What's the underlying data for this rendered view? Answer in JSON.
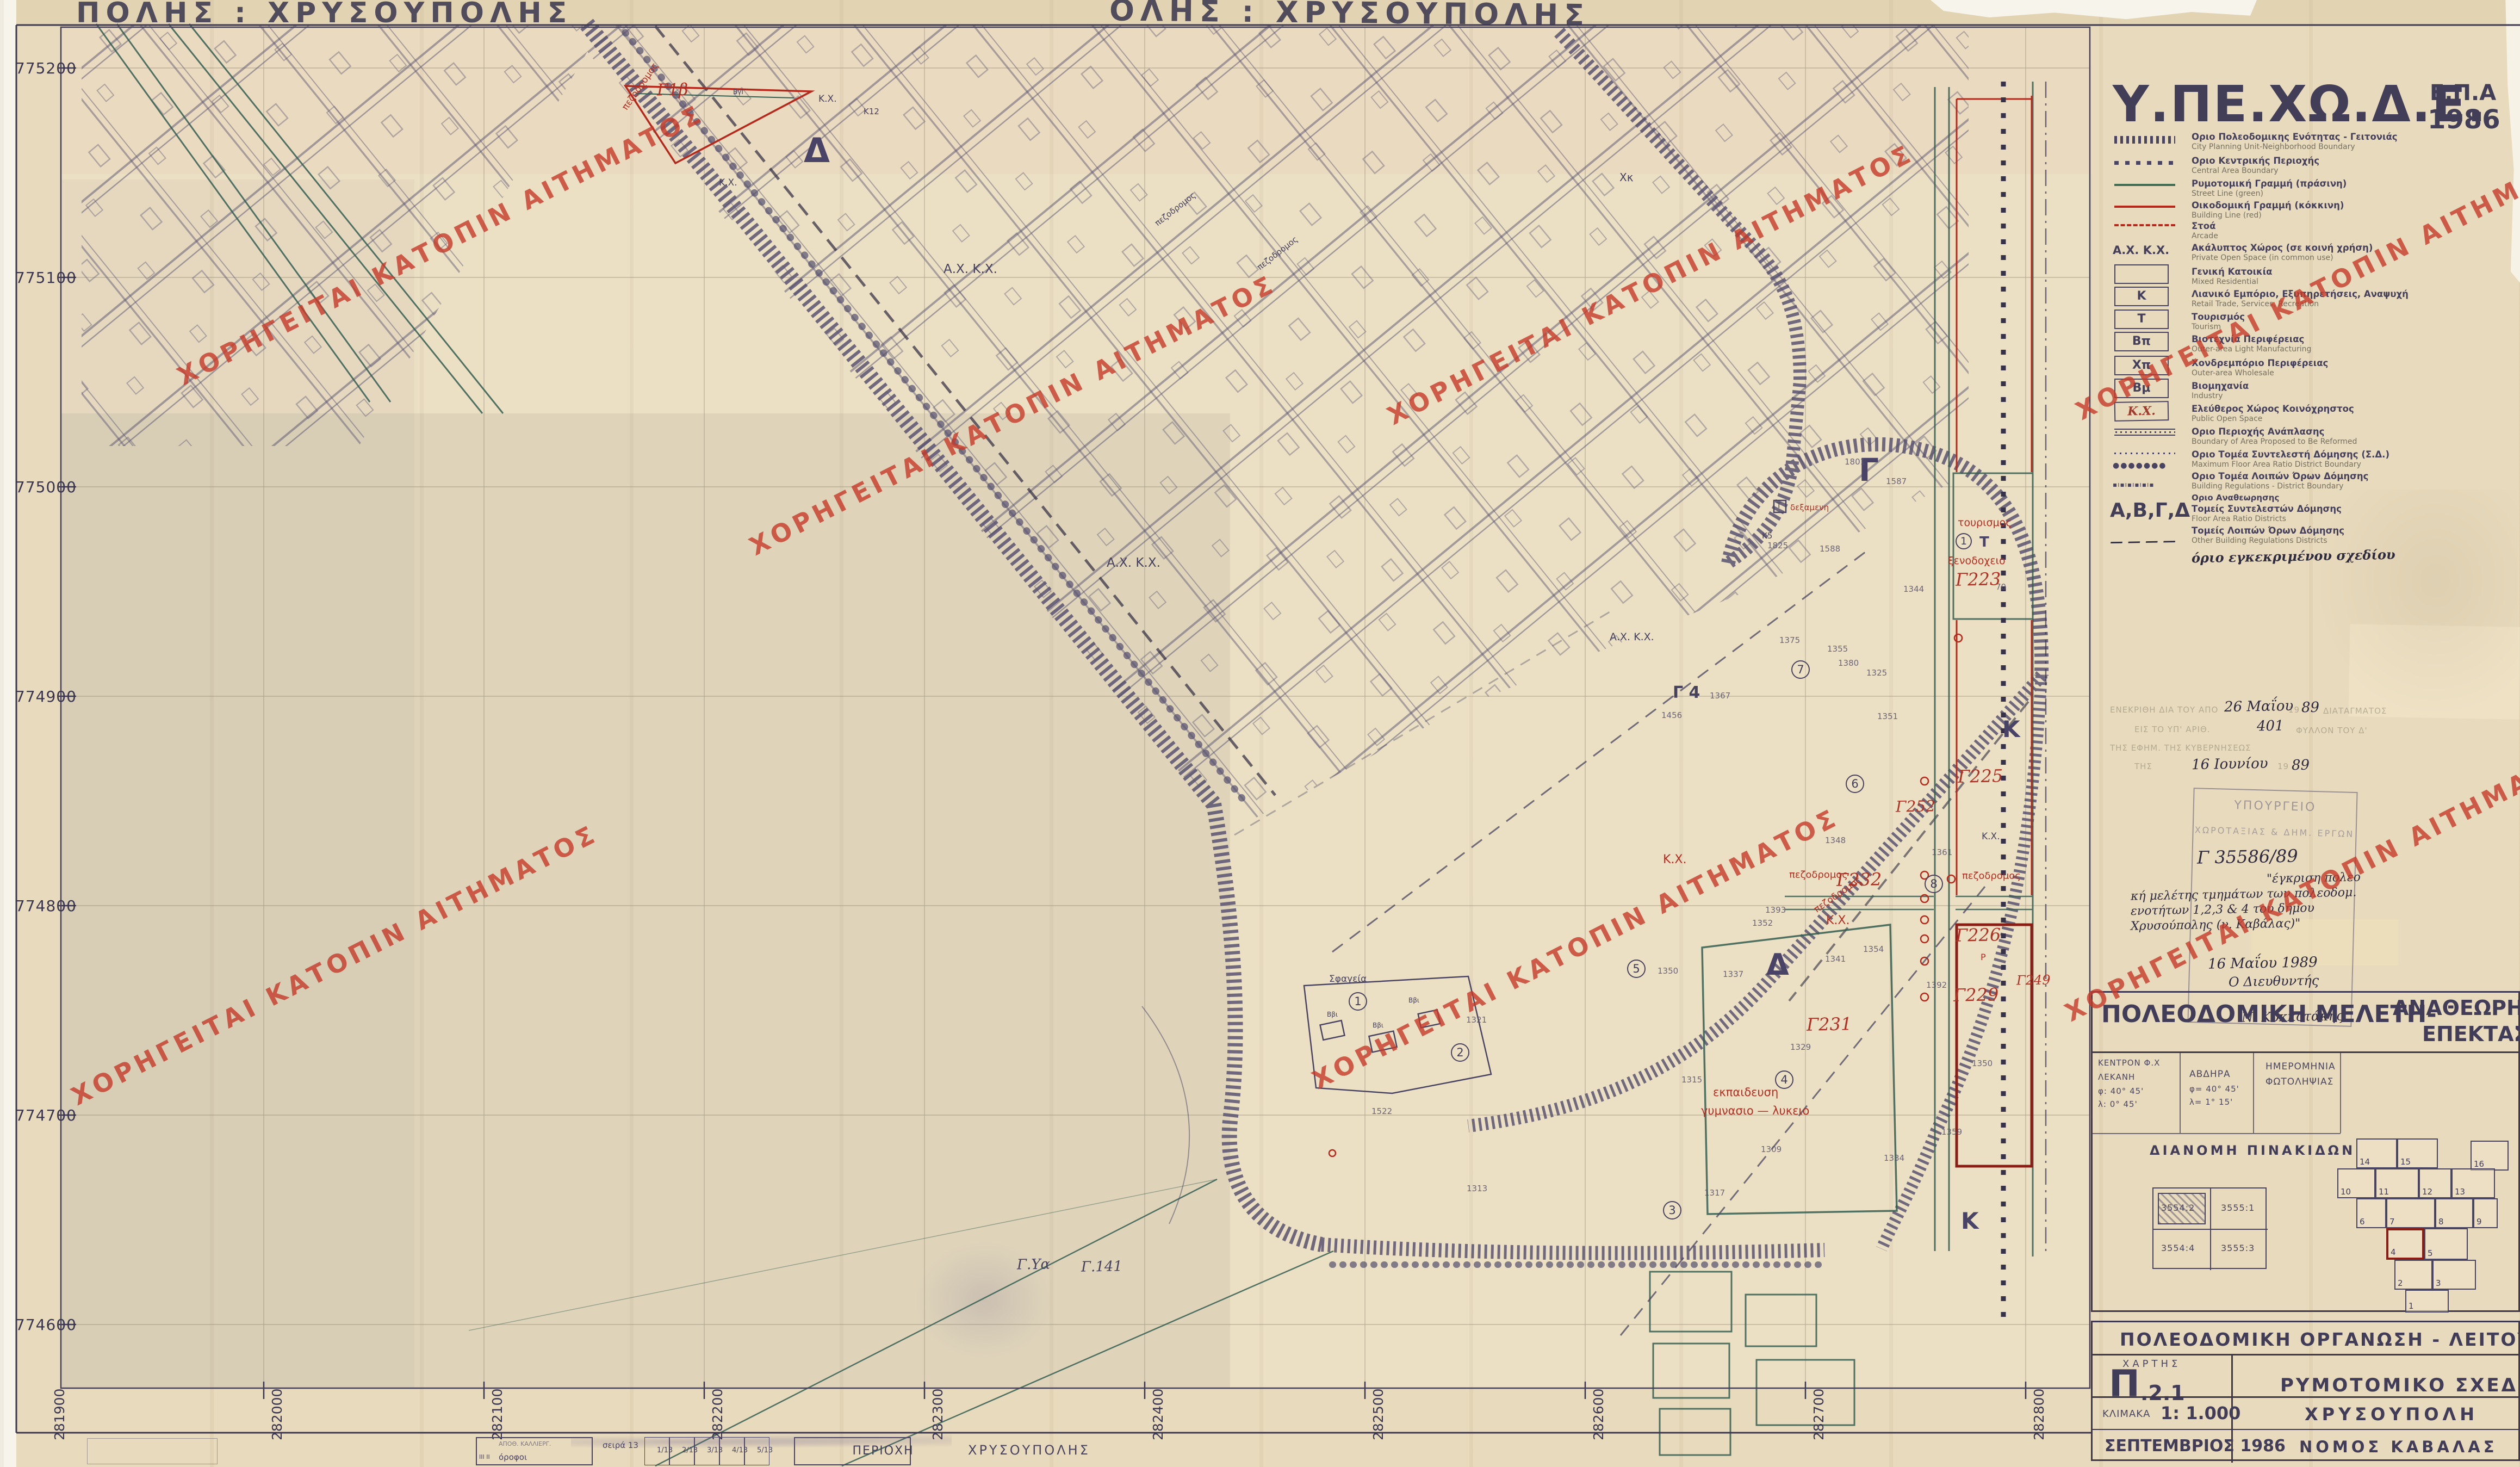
{
  "page": {
    "watermark_text": "ΧΟΡΗΓΕΙΤΑΙ ΚΑΤΟΠΙΝ ΑΙΤΗΜΑΤΟΣ",
    "watermark_color": "#c43b2a"
  },
  "margins": {
    "stencil_left": "ΠΟΛΗΣ :  ΧΡΥΣΟΥΠΟΛΗΣ",
    "stencil_center": "ΟΛΗΣ :  ΧΡΥΣΟΥΠΟΛΗΣ",
    "strip": {
      "apoth": "ΑΠΟΘ. ΚΑΛΛΙΕΡΓ.",
      "orofoi": "όροφοι",
      "marks": "ΙΙΙ ΙΙ",
      "seira": "σειρά 13",
      "cells": [
        "1/13",
        "2/13",
        "3/13",
        "4/13",
        "5/13"
      ],
      "periochi": "ΠΕΡΙΟΧΗ",
      "poli": "ΧΡΥΣΟΥΠΟΛΗΣ"
    }
  },
  "header": {
    "ministry": "Υ.ΠΕ.ΧΩ.Δ.Ε.",
    "epa": "Ε.Π.Α",
    "year": "1986"
  },
  "legend": {
    "items": [
      {
        "gr": "Οριο Πολεοδομικης Ενότητας - Γειτονιάς",
        "en": "City Planning Unit-Neighborhood Boundary"
      },
      {
        "gr": "Οριο Κεντρικής Περιοχής",
        "en": "Central Area Boundary"
      },
      {
        "gr": "Ρυμοτομική Γραμμή (πράσινη)",
        "en": "Street Line (green)"
      },
      {
        "gr": "Οικοδομική Γραμμή (κόκκινη)",
        "en": "Building Line (red)"
      },
      {
        "gr": "Στοά",
        "en": "Arcade"
      },
      {
        "gr": "Ακάλυπτος Χώρος (σε κοινή χρήση)",
        "en": "Private Open Space (in common use)",
        "sym_label": "Α.Χ. Κ.Χ."
      },
      {
        "gr": "Γενική Κατοικία",
        "en": "Mixed Residential",
        "box": ""
      },
      {
        "gr": "Λιανικό Εμπόριο, Εξυπηρετήσεις, Αναψυχή",
        "en": "Retail Trade, Services, Recreation",
        "box": "Κ"
      },
      {
        "gr": "Τουρισμός",
        "en": "Tourism",
        "box": "Τ"
      },
      {
        "gr": "Βιοτεχνία Περιφέρειας",
        "en": "Outer-area Light Manufacturing",
        "box": "Βπ"
      },
      {
        "gr": "Χονδρεμπόριο Περιφέρειας",
        "en": "Outer-area Wholesale",
        "box": "Χπ"
      },
      {
        "gr": "Βιομηχανία",
        "en": "Industry",
        "box": "Βμ"
      },
      {
        "gr": "Ελεύθερος Χώρος Κοινόχρηστος",
        "en": "Public Open Space",
        "box": "Κ.Χ."
      },
      {
        "gr": "Οριο Περιοχής Ανάπλασης",
        "en": "Boundary of Area Proposed to Be Reformed"
      },
      {
        "gr": "Οριο Τομέα Συντελεστή Δόμησης (Σ.Δ.)",
        "en": "Maximum Floor Area Ratio District Boundary"
      },
      {
        "gr": "Οριο Τομέα Λοιπών Όρων Δόμησης",
        "en": "Building Regulations - District Boundary",
        "sym_label": "●●●●●●●"
      },
      {
        "gr": "Οριο Αναθεωρησης",
        "en": "",
        "sym_label": "▪ı▪ı▪ı▪ı▪ı▪"
      },
      {
        "gr": "Τομείς Συντελεστών Δόμησης",
        "en": "Floor Area Ratio Districts",
        "gr2": "Τομείς Λοιπών Όρων Δόμησης",
        "en2": "Other Building Regulations Districts",
        "sym_label": "Α,Β,Γ,Δ"
      },
      {
        "gr": "όριο εγκεκριμένου σχεδίου",
        "en": "",
        "sym_label": "— — — —"
      }
    ]
  },
  "axes": {
    "left": [
      "775200",
      "775100",
      "775000",
      "774900",
      "774800",
      "774700",
      "774600"
    ],
    "bottom": [
      "281900",
      "282000",
      "282100",
      "282200",
      "282300",
      "282400",
      "282500",
      "282600",
      "282700",
      "282800"
    ]
  },
  "stamp": {
    "typed1a": "ΕΝΕΚΡΙΘΗ ΔΙΑ ΤΟΥ ΑΠΟ",
    "hw_date1": "26 Μαΐου",
    "typed_19a": "19",
    "hw_89a": "89",
    "typed1b": "ΔΙΑΤΑΓΜΑΤΟΣ",
    "typed2a": "ΕΙΣ ΤΟ ΥΠ' ΑΡΙΘ.",
    "hw_401": "401",
    "typed2b": "ΦΥΛΛΟΝ ΤΟΥ Δ'",
    "typed3": "ΤΗΣ ΕΦΗΜ. ΤΗΣ ΚΥΒΕΡΝΗΣΕΩΣ",
    "typed4": "ΤΗΣ",
    "hw_date2": "16 Ιουνίου",
    "typed_19b": "19",
    "hw_89b": "89",
    "box_line1": "ΥΠΟΥΡΓΕΙΟ",
    "box_line2": "ΧΩΡΟΤΑΞΙΑΣ & ΔΗΜ. ΕΡΓΩΝ",
    "protocol": "Γ 35586/89",
    "note1": "\"έγκριση πολεο",
    "note2": "κή μελέτης τμημάτων των πολεοδομ.",
    "note3": "ενοτήτων 1,2,3 & 4 του δήμου",
    "note4": "Χρυσούπολης (ν. Καβάλας)\"",
    "hw_date3": "16 Μαΐου 1989",
    "director": "Ο Διευθυντής",
    "signature": "Ν. Κοκκοτάκης"
  },
  "panel": {
    "title1": "ΠΟΛΕΟΔΟΜΙΚΗ ΜΕΛΕΤΗ-",
    "title2": "ΑΝΑΘΕΩΡΗΣΗ",
    "title3": "ΕΠΕΚΤΑΣΗ",
    "kentron": "ΚΕΝΤΡΟΝ Φ.Χ",
    "lekani": "ΛΕΚΑΝΗ",
    "f1": "φ: 40° 45'",
    "l1": "λ: 0° 45'",
    "avdira": "ΑΒΔΗΡΑ",
    "f2": "φ= 40° 45'",
    "l2": "λ= 1° 15'",
    "imerominia": "ΗΜΕΡΟΜΗΝΙΑ",
    "fotolipsias": "ΦΩΤΟΛΗΨΙΑΣ",
    "dianomi": "ΔΙΑΝΟΜΗ  ΠΙΝΑΚΙΔΩΝ",
    "sheets": [
      "3554:2",
      "3555:1",
      "3554:4",
      "3555:3"
    ],
    "tiles": [
      "14",
      "15",
      "16",
      "10",
      "11",
      "12",
      "13",
      "6",
      "7",
      "8",
      "9",
      "4",
      "5",
      "2",
      "3",
      "1"
    ]
  },
  "titleblock": {
    "row1": "ΠΟΛΕΟΔΟΜΙΚΗ  ΟΡΓΑΝΩΣΗ - ΛΕΙΤΟΥΡΓΙΕΣ",
    "xartis": "ΧΑΡΤΗΣ",
    "code_big": "Π",
    "code_rest": ".2.1",
    "drawing": "ΡΥΜΟΤΟΜΙΚΟ  ΣΧΕΔΙΟ",
    "klimaka": "ΚΛΙΜΑΚΑ",
    "scale": "1:  1.000",
    "date": "ΣΕΠΤΕΜΒΡΙΟΣ 1986",
    "city": "ΧΡΥΣΟΥΠΟΛΗ",
    "prefecture": "ΝΟΜΟΣ   ΚΑΒΑΛΑΣ"
  },
  "map": {
    "letters": {
      "d": "Δ",
      "g": "Γ",
      "k": "Κ",
      "t": "Τ"
    },
    "circled": [
      "1",
      "2",
      "3",
      "4",
      "5",
      "6",
      "7",
      "8"
    ],
    "red": {
      "g1b": "Γ1β",
      "g223": "Γ223",
      "g225": "Γ225",
      "g226": "Γ226",
      "g229": "Γ229",
      "g231": "Γ231",
      "g232": "Γ232",
      "g252": "Γ252",
      "g249": "Γ249",
      "tourismos": "τουρισμος",
      "xenodocheio": "ξενοδοχειο",
      "dexameni": "δεξαμενη",
      "ekpaideusi": "εκπαιδευση",
      "gymnasio": "γυμνασιο — λυκειο",
      "pezodromos": "πεζοδρομος",
      "kx": "Κ.Χ.",
      "p": "Ρ"
    },
    "dark": {
      "axkx": "Α.Χ. Κ.Χ.",
      "kx": "Κ.Χ.",
      "sfageia": "Σφαγεία",
      "g4": "Γ 4",
      "k5": "Κ5",
      "k12": "Κ12",
      "bbi": "Ββι",
      "bgi": "ΒγΙ",
      "gya": "Γ.Υα",
      "g141": "Γ.141",
      "xk": "Χκ",
      "pez": "πεζοδρομος"
    },
    "parcels": [
      "1375",
      "1380",
      "1351",
      "1456",
      "1348",
      "1352",
      "1354",
      "1350",
      "1361",
      "1337",
      "1341",
      "1329",
      "1315",
      "1309",
      "1317",
      "1334",
      "1392",
      "1359",
      "1393",
      "1801",
      "1587",
      "1588",
      "1825",
      "1344",
      "1355",
      "1325",
      "1522",
      "1321",
      "1350",
      "1313",
      "1367",
      "70"
    ]
  }
}
